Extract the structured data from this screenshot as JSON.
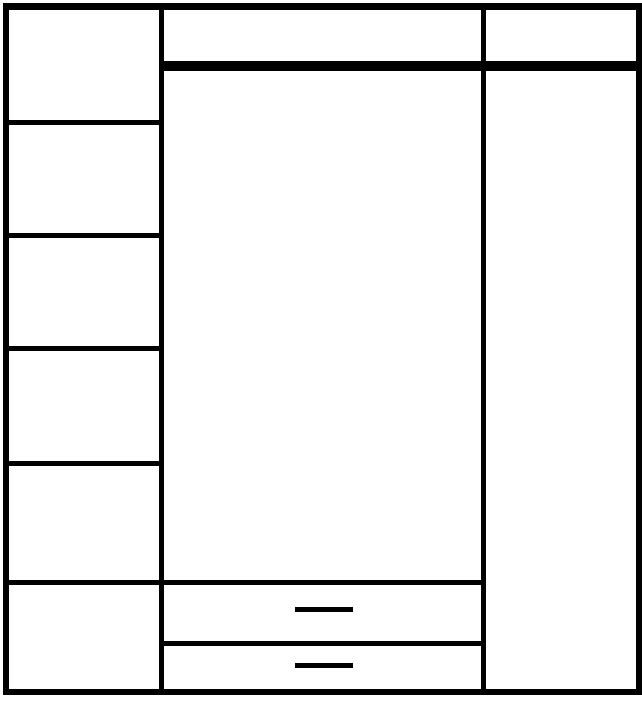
{
  "colors": {
    "background": "#ffffff",
    "line": "#000000"
  },
  "structure": {
    "type": "blank-ruled-table",
    "left_column_cell_count": 6,
    "header_cell_count": 2,
    "bottom_dash_row_count": 2,
    "dash_mark_count": 2,
    "text_content": ""
  }
}
